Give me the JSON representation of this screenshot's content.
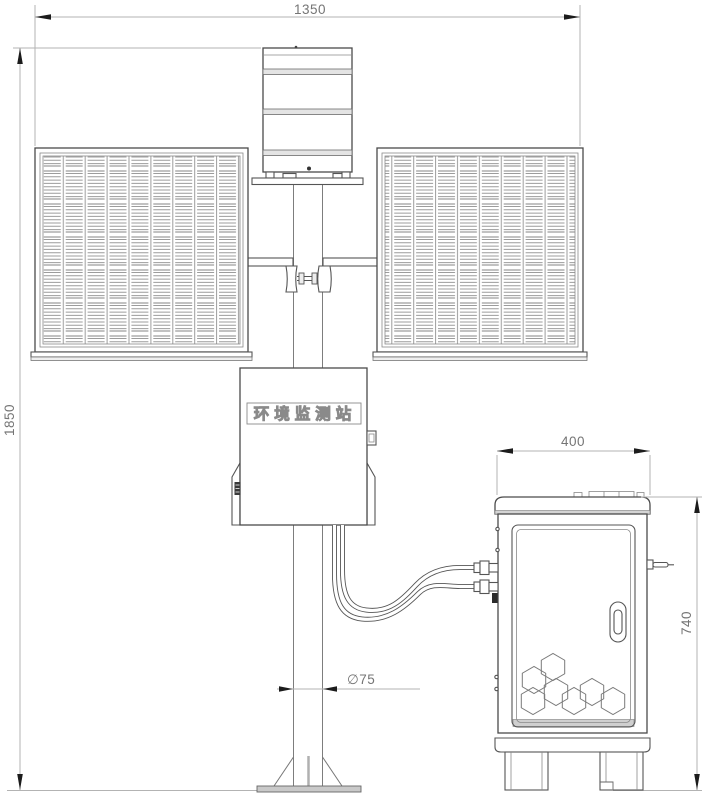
{
  "labels": {
    "station_name": "环境监测站",
    "dim_width_top": "1350",
    "dim_height_left": "1850",
    "dim_cabinet_width": "400",
    "dim_cabinet_height": "740",
    "dim_pole_diameter": "∅75"
  },
  "colors": {
    "background": "#ffffff",
    "object_line": "#555555",
    "light_line": "#8a8a8a",
    "dimension_line": "#b3b3b3",
    "dimension_text": "#757575",
    "arrow_fill": "#1c1c1c",
    "gray_fill": "#d4d4d4"
  }
}
